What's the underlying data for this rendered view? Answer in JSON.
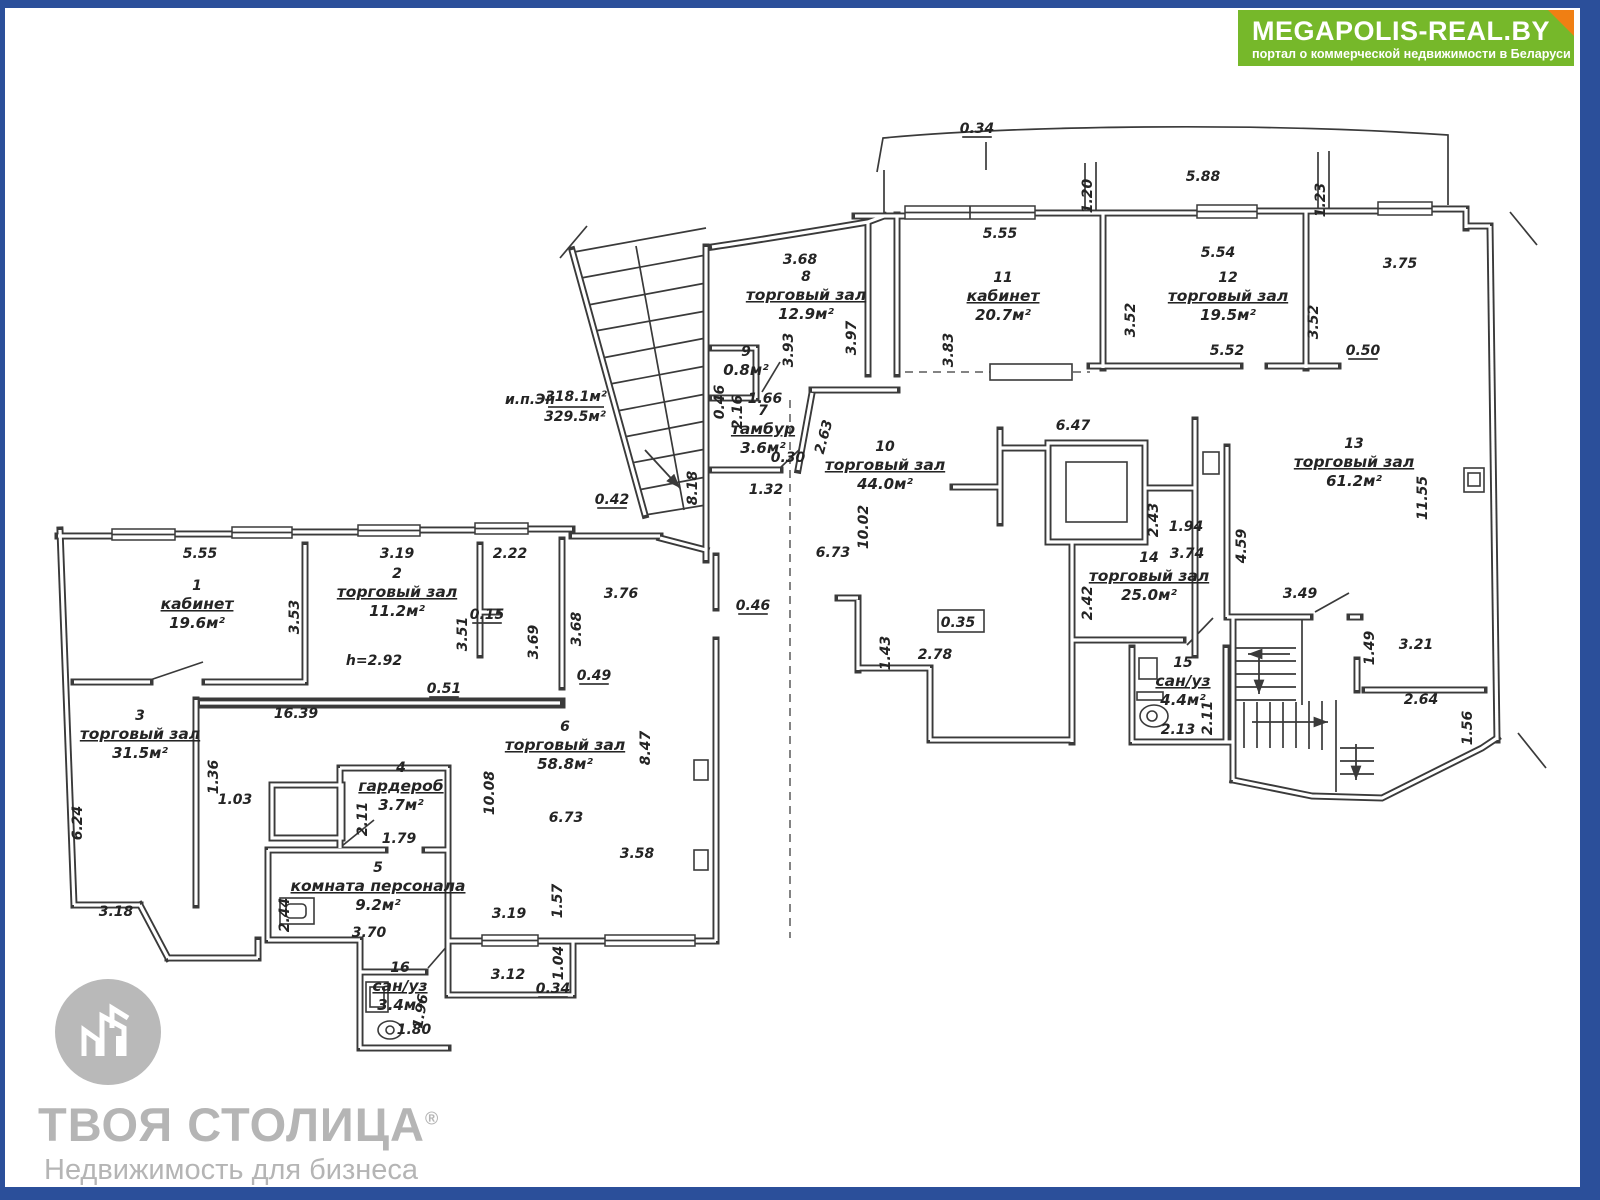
{
  "banner": {
    "title": "MEGAPOLIS-REAL.BY",
    "subtitle": "портал о коммерческой недвижимости в Беларуси",
    "bg_color": "#76b82a",
    "fold_color": "#f07f13"
  },
  "watermark": {
    "brand": "ТВОЯ СТОЛИЦА",
    "reg_mark": "®",
    "tagline": "Недвижимость для бизнеса",
    "color": "#b5b5b5"
  },
  "frame_color": "#2b4f9a",
  "plan": {
    "total_label": [
      {
        "t": "и.п.Эн",
        "x": 530,
        "y": 404
      },
      {
        "t": "318.1м²",
        "x": 576,
        "y": 401,
        "u": 1
      },
      {
        "t": "329.5м²",
        "x": 575,
        "y": 421
      }
    ],
    "rooms": [
      {
        "num": "1",
        "name": "кабинет",
        "area": "19.6м²",
        "x": 197,
        "y": 609
      },
      {
        "num": "2",
        "name": "торговый зал",
        "area": "11.2м²",
        "x": 397,
        "y": 597
      },
      {
        "num": "3",
        "name": "торговый зал",
        "area": "31.5м²",
        "x": 140,
        "y": 739
      },
      {
        "num": "4",
        "name": "гардероб",
        "area": "3.7м²",
        "x": 401,
        "y": 791
      },
      {
        "num": "5",
        "name": "комната персонала",
        "area": "9.2м²",
        "x": 378,
        "y": 891
      },
      {
        "num": "6",
        "name": "торговый зал",
        "area": "58.8м²",
        "x": 565,
        "y": 750
      },
      {
        "num": "7",
        "name": "тамбур",
        "area": "3.6м²",
        "x": 763,
        "y": 434
      },
      {
        "num": "8",
        "name": "торговый зал",
        "area": "12.9м²",
        "x": 806,
        "y": 300
      },
      {
        "num": "9",
        "name": "",
        "area": "0.8м²",
        "x": 746,
        "y": 375
      },
      {
        "num": "10",
        "name": "торговый зал",
        "area": "44.0м²",
        "x": 885,
        "y": 470
      },
      {
        "num": "11",
        "name": "кабинет",
        "area": "20.7м²",
        "x": 1003,
        "y": 301
      },
      {
        "num": "12",
        "name": "торговый зал",
        "area": "19.5м²",
        "x": 1228,
        "y": 301
      },
      {
        "num": "13",
        "name": "торговый зал",
        "area": "61.2м²",
        "x": 1354,
        "y": 467
      },
      {
        "num": "14",
        "name": "торговый зал",
        "area": "25.0м²",
        "x": 1149,
        "y": 581
      },
      {
        "num": "15",
        "name": "сан/уз",
        "area": "4.4м²",
        "x": 1183,
        "y": 686
      },
      {
        "num": "16",
        "name": "сан/уз",
        "area": "3.4м²",
        "x": 400,
        "y": 991
      }
    ],
    "dims": [
      {
        "t": "0.34",
        "x": 977,
        "y": 133,
        "u": 1
      },
      {
        "t": "5.88",
        "x": 1203,
        "y": 181
      },
      {
        "t": "1.20",
        "x": 1092,
        "y": 196,
        "r": -90
      },
      {
        "t": "1.23",
        "x": 1325,
        "y": 200,
        "r": -90
      },
      {
        "t": "5.55",
        "x": 1000,
        "y": 238
      },
      {
        "t": "5.54",
        "x": 1218,
        "y": 257
      },
      {
        "t": "3.75",
        "x": 1400,
        "y": 268
      },
      {
        "t": "3.68",
        "x": 800,
        "y": 264
      },
      {
        "t": "3.93",
        "x": 793,
        "y": 350,
        "r": -90
      },
      {
        "t": "3.97",
        "x": 856,
        "y": 338,
        "r": -90
      },
      {
        "t": "3.83",
        "x": 953,
        "y": 350,
        "r": -90
      },
      {
        "t": "3.52",
        "x": 1135,
        "y": 320,
        "r": -90
      },
      {
        "t": "3.52",
        "x": 1318,
        "y": 322,
        "r": -90
      },
      {
        "t": "5.52",
        "x": 1227,
        "y": 355
      },
      {
        "t": "0.50",
        "x": 1363,
        "y": 355,
        "u": 1
      },
      {
        "t": "0.46",
        "x": 724,
        "y": 402,
        "r": -90
      },
      {
        "t": "2.16",
        "x": 742,
        "y": 412,
        "r": -90
      },
      {
        "t": "1.66",
        "x": 765,
        "y": 403
      },
      {
        "t": "2.63",
        "x": 828,
        "y": 438,
        "r": -75
      },
      {
        "t": "0.30",
        "x": 788,
        "y": 462
      },
      {
        "t": "1.32",
        "x": 766,
        "y": 494
      },
      {
        "t": "8.18",
        "x": 697,
        "y": 488,
        "r": -90
      },
      {
        "t": "0.42",
        "x": 612,
        "y": 504,
        "u": 1
      },
      {
        "t": "6.47",
        "x": 1073,
        "y": 430
      },
      {
        "t": "10.02",
        "x": 868,
        "y": 527,
        "r": -90
      },
      {
        "t": "6.73",
        "x": 833,
        "y": 557
      },
      {
        "t": "2.78",
        "x": 935,
        "y": 659
      },
      {
        "t": "1.43",
        "x": 890,
        "y": 653,
        "r": -90
      },
      {
        "t": "0.35",
        "x": 958,
        "y": 627
      },
      {
        "t": "2.43",
        "x": 1158,
        "y": 520,
        "r": -90
      },
      {
        "t": "1.94",
        "x": 1186,
        "y": 531
      },
      {
        "t": "3.74",
        "x": 1187,
        "y": 558
      },
      {
        "t": "2.42",
        "x": 1092,
        "y": 603,
        "r": -90
      },
      {
        "t": "4.59",
        "x": 1246,
        "y": 546,
        "r": -90
      },
      {
        "t": "11.55",
        "x": 1427,
        "y": 498,
        "r": -90
      },
      {
        "t": "3.49",
        "x": 1300,
        "y": 598
      },
      {
        "t": "1.49",
        "x": 1374,
        "y": 648,
        "r": -90
      },
      {
        "t": "3.21",
        "x": 1416,
        "y": 649
      },
      {
        "t": "2.64",
        "x": 1421,
        "y": 704
      },
      {
        "t": "1.56",
        "x": 1472,
        "y": 728,
        "r": -90
      },
      {
        "t": "2.13",
        "x": 1178,
        "y": 734
      },
      {
        "t": "2.11",
        "x": 1212,
        "y": 718,
        "r": -90
      },
      {
        "t": "5.55",
        "x": 200,
        "y": 558
      },
      {
        "t": "3.53",
        "x": 299,
        "y": 617,
        "r": -90
      },
      {
        "t": "3.19",
        "x": 397,
        "y": 558
      },
      {
        "t": "3.51",
        "x": 467,
        "y": 634,
        "r": -90
      },
      {
        "t": "2.22",
        "x": 510,
        "y": 558
      },
      {
        "t": "0.15",
        "x": 487,
        "y": 619,
        "u": 1
      },
      {
        "t": "h=2.92",
        "x": 374,
        "y": 665
      },
      {
        "t": "0.51",
        "x": 444,
        "y": 693,
        "u": 1
      },
      {
        "t": "16.39",
        "x": 296,
        "y": 718
      },
      {
        "t": "3.76",
        "x": 621,
        "y": 598
      },
      {
        "t": "3.68",
        "x": 581,
        "y": 629,
        "r": -90
      },
      {
        "t": "3.69",
        "x": 538,
        "y": 642,
        "r": -90
      },
      {
        "t": "0.49",
        "x": 594,
        "y": 680,
        "u": 1
      },
      {
        "t": "0.46",
        "x": 753,
        "y": 610,
        "u": 1
      },
      {
        "t": "6.24",
        "x": 82,
        "y": 823,
        "r": -90
      },
      {
        "t": "3.18",
        "x": 116,
        "y": 916
      },
      {
        "t": "1.36",
        "x": 218,
        "y": 777,
        "r": -90
      },
      {
        "t": "1.03",
        "x": 235,
        "y": 804
      },
      {
        "t": "2.11",
        "x": 367,
        "y": 819,
        "r": -90
      },
      {
        "t": "1.79",
        "x": 399,
        "y": 843
      },
      {
        "t": "2.44",
        "x": 289,
        "y": 915,
        "r": -90
      },
      {
        "t": "3.70",
        "x": 369,
        "y": 937
      },
      {
        "t": "10.08",
        "x": 494,
        "y": 793,
        "r": -90
      },
      {
        "t": "6.73",
        "x": 566,
        "y": 822
      },
      {
        "t": "8.47",
        "x": 650,
        "y": 748,
        "r": -90
      },
      {
        "t": "3.58",
        "x": 637,
        "y": 858
      },
      {
        "t": "1.57",
        "x": 562,
        "y": 901,
        "r": -90
      },
      {
        "t": "3.19",
        "x": 509,
        "y": 918
      },
      {
        "t": "3.12",
        "x": 508,
        "y": 979
      },
      {
        "t": "1.04",
        "x": 563,
        "y": 963,
        "r": -90
      },
      {
        "t": "0.34",
        "x": 553,
        "y": 993,
        "u": 1
      },
      {
        "t": "1.96",
        "x": 425,
        "y": 1012,
        "r": -80
      },
      {
        "t": "1.80",
        "x": 414,
        "y": 1034
      }
    ]
  }
}
